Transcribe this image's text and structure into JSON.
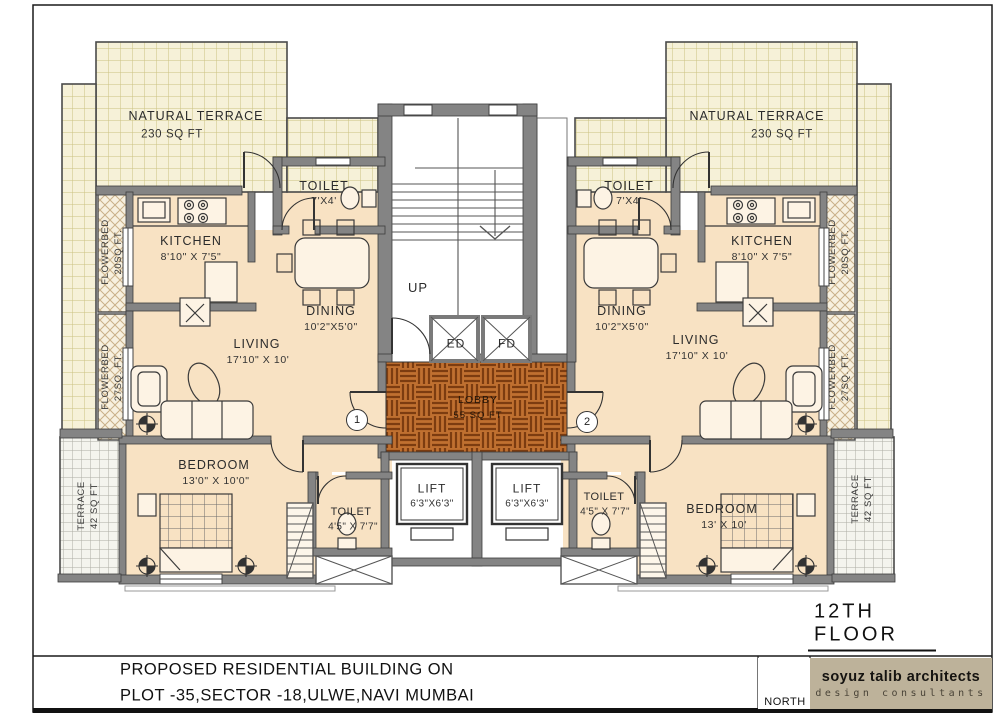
{
  "sheet": {
    "floor_label": "12TH  FLOOR",
    "title_line1": "PROPOSED RESIDENTIAL BUILDING ON",
    "title_line2": "PLOT -35,SECTOR -18,ULWE,NAVI MUMBAI",
    "architect_name": "soyuz talib  architects",
    "architect_tagline": "design consultants",
    "north_label": "NORTH"
  },
  "colors": {
    "room_fill": "#f8e2c3",
    "wall_gray": "#848484",
    "terrace_grid": "#f6f1d8",
    "lobby_wood": "#c07030",
    "architect_block": "#bdb29a"
  },
  "core": {
    "up_label": "UP",
    "duct_left": "ED",
    "duct_right": "FD",
    "lobby_name": "LOBBY",
    "lobby_area": "55 SQ FT",
    "lift1_name": "LIFT",
    "lift1_dims": "6'3\"X6'3\"",
    "lift2_name": "LIFT",
    "lift2_dims": "6'3\"X6'3\""
  },
  "unit1": {
    "flat_no": "1",
    "terrace_name": "NATURAL TERRACE",
    "terrace_area": "230 SQ FT",
    "kitchen_name": "KITCHEN",
    "kitchen_dims": "8'10\" X 7'5\"",
    "toilet_top_name": "TOILET",
    "toilet_top_dims": "7'X4'",
    "dining_name": "DINING",
    "dining_dims": "10'2\"X5'0\"",
    "living_name": "LIVING",
    "living_dims": "17'10\" X 10'",
    "bedroom_name": "BEDROOM",
    "bedroom_dims": "13'0\" X 10'0\"",
    "toilet_bottom_name": "TOILET",
    "toilet_bottom_dims": "4'5\" X 7'7\"",
    "flowerbed_top_name": "FLOWERBED",
    "flowerbed_top_area": "20SQ FT.",
    "flowerbed_mid_name": "FLOWERBED",
    "flowerbed_mid_area": "27SQ. FT.",
    "terrace_side_name": "TERRACE",
    "terrace_side_area": "42 SQ FT"
  },
  "unit2": {
    "flat_no": "2",
    "terrace_name": "NATURAL TERRACE",
    "terrace_area": "230 SQ FT",
    "kitchen_name": "KITCHEN",
    "kitchen_dims": "8'10\" X 7'5\"",
    "toilet_top_name": "TOILET",
    "toilet_top_dims": "7'X4'",
    "dining_name": "DINING",
    "dining_dims": "10'2\"X5'0\"",
    "living_name": "LIVING",
    "living_dims": "17'10\" X 10'",
    "bedroom_name": "BEDROOM",
    "bedroom_dims": "13' X 10'",
    "toilet_bottom_name": "TOILET",
    "toilet_bottom_dims": "4'5\" X 7'7\"",
    "flowerbed_top_name": "FLOWERBED",
    "flowerbed_top_area": "20SQ FT.",
    "flowerbed_mid_name": "FLOWERBED",
    "flowerbed_mid_area": "27SQ. FT.",
    "terrace_side_name": "TERRACE",
    "terrace_side_area": "42 SQ FT"
  }
}
